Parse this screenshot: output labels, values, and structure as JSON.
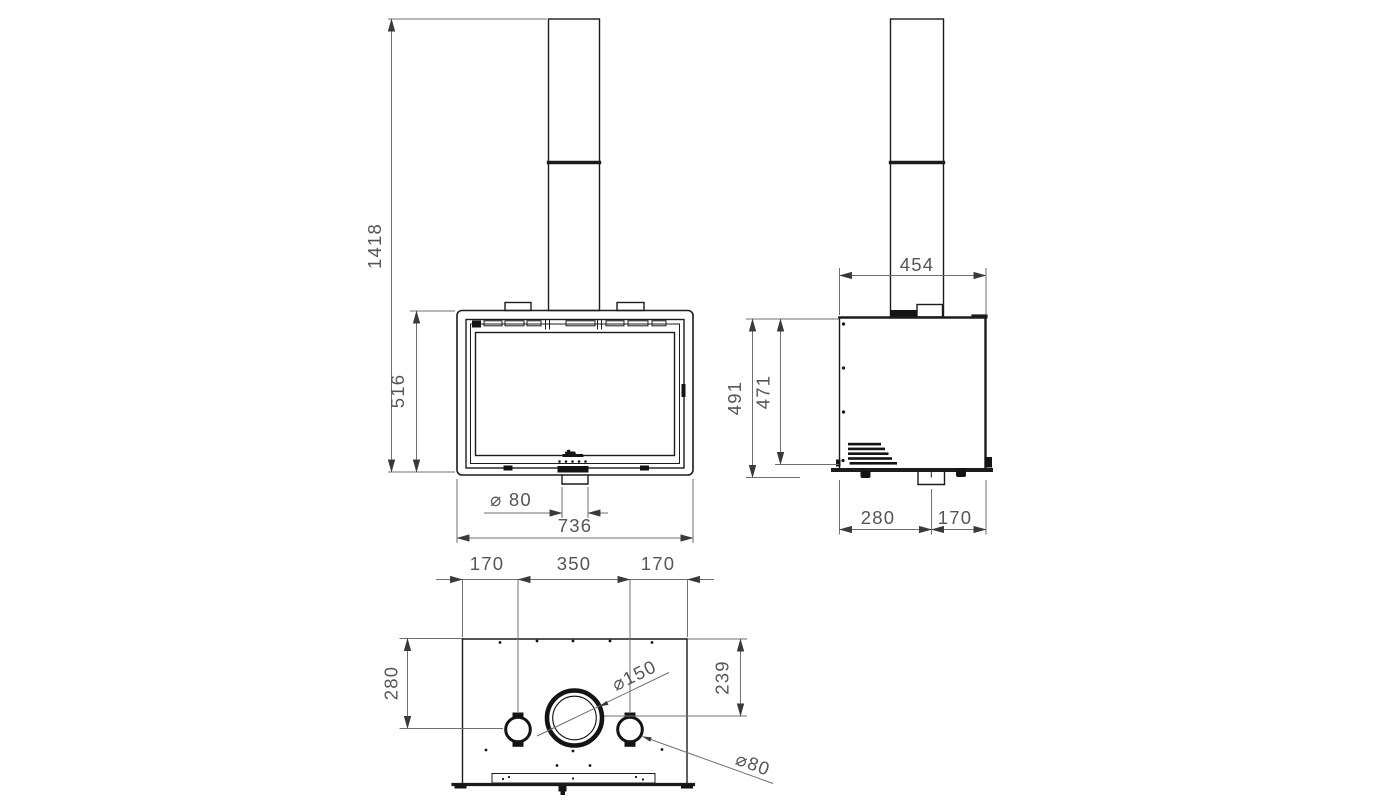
{
  "drawing": {
    "colors": {
      "background": "#ffffff",
      "part_line": "#1c1c1c",
      "dimension_line": "#6f6f6f",
      "dimension_text": "#565656"
    },
    "front": {
      "overall_height": "1418",
      "body_height": "516",
      "outlet_diameter": "⌀ 80",
      "body_width": "736"
    },
    "side": {
      "top_depth": "454",
      "outer_height": "491",
      "inner_height": "471",
      "bottom_rear": "280",
      "bottom_front": "170"
    },
    "bottom": {
      "edge_to_duct_left": "170",
      "duct_spacing": "350",
      "edge_to_duct_right": "170",
      "depth_to_ducts": "280",
      "depth_to_flue": "239",
      "flue_diameter": "⌀150",
      "duct_diameter": "⌀80"
    }
  }
}
